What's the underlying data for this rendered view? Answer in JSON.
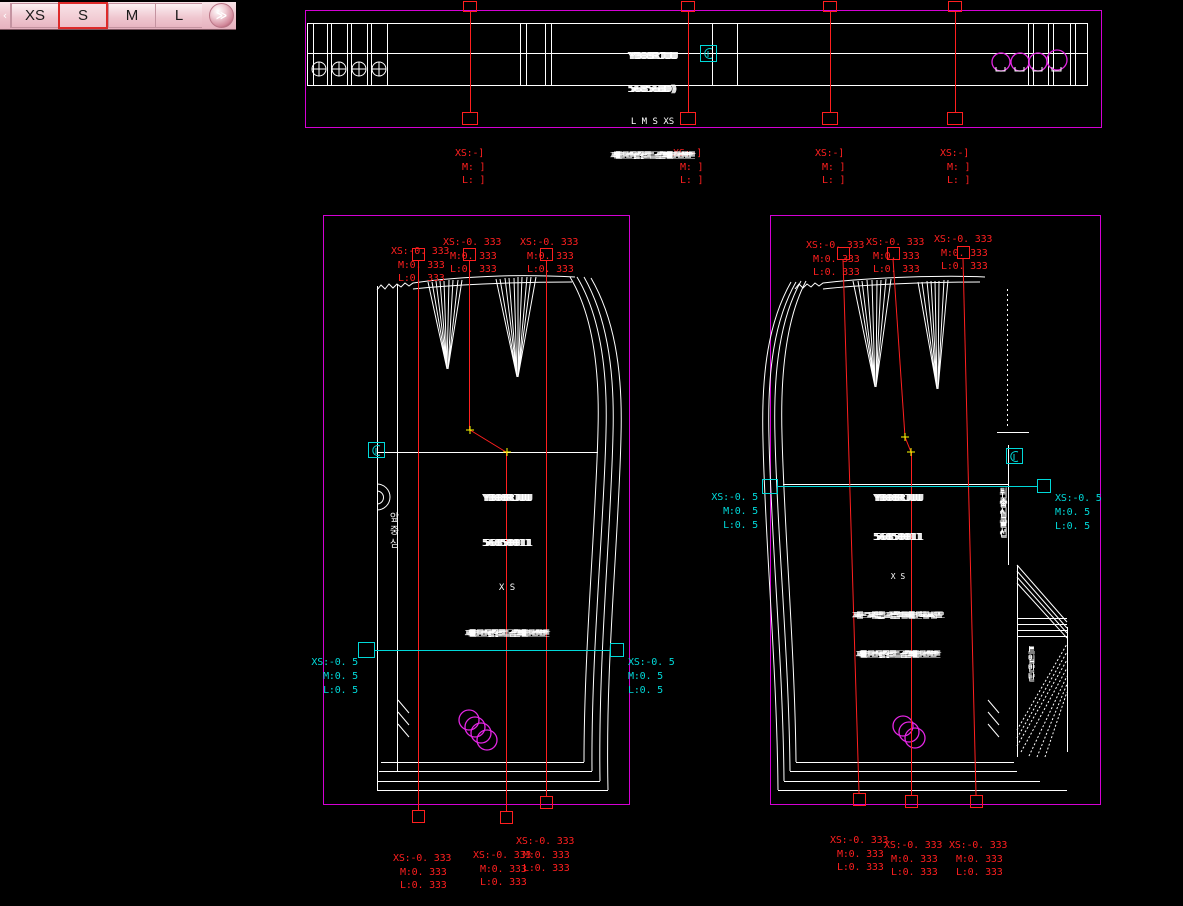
{
  "tabs": {
    "prev": "‹",
    "items": [
      {
        "label": "XS",
        "selected": false
      },
      {
        "label": "S",
        "selected": true
      },
      {
        "label": "M",
        "selected": false
      },
      {
        "label": "L",
        "selected": false
      }
    ],
    "more": "≫"
  },
  "colors": {
    "background": "#000000",
    "piece_outline": "#ffffff",
    "bounding_box_magenta": "#d400d4",
    "grading_red": "#ff1f1f",
    "measure_cyan": "#00d9d9",
    "match_point_yellow": "#ffff00",
    "tab_selected_border": "#dd2a2a"
  },
  "grading": {
    "band": {
      "xs": "XS:-]",
      "m": "M: ]",
      "l": "L: ]"
    },
    "third": {
      "xs": "XS:-0. 333",
      "m": "M:0. 333",
      "l": "L:0. 333"
    },
    "half": {
      "xs": "XS:-0. 5",
      "m": "M:0. 5",
      "l": "L:0. 5"
    }
  },
  "piece_text": {
    "band": {
      "l1": "YB08RJUU",
      "l2": "56856BD)",
      "l3": "L M S XS",
      "l4": "재단선겉감두겹재단선안"
    },
    "front": {
      "l1": "YB08RJUU",
      "l2": "56850011",
      "l3": "X S",
      "l4": "재단선겉감두겹재단선안",
      "center_front": "앞중심"
    },
    "back": {
      "l1": "YB08RJUU",
      "l2": "56850011",
      "l3": "X S",
      "l4": "자르지않고접어재단하시오",
      "l5": "재단선겉감두겹재단선안",
      "center_back": "뒤중심골선",
      "vent": "트임안단"
    }
  }
}
